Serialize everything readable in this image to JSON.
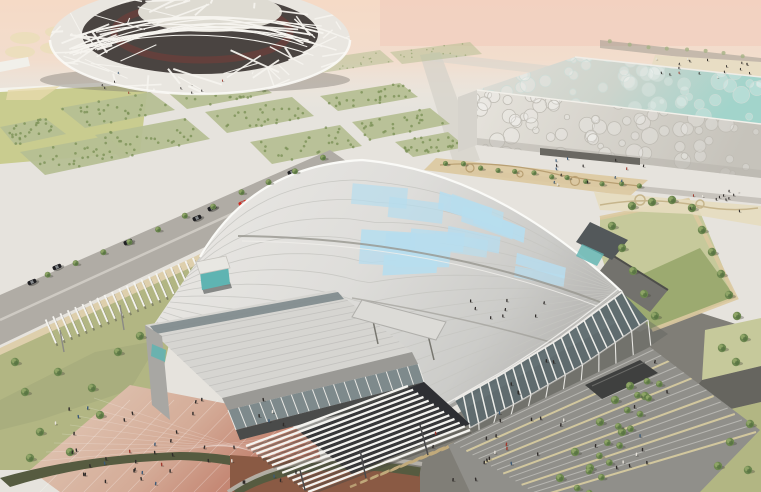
{
  "scene": {
    "description": "Aerial architectural rendering of an Olympic green: a white lattice bowl stadium at upper left, a rectangular bubble-skinned aquatics hall at upper right, and in the foreground a large arena with a curved white panel roof, blue skylight patches, glass walls, white louvered canopies, a grand stair plaza with crowds, roads with cars, lawns, tree groves and tan promenades under a hazy pink horizon.",
    "palette": {
      "skyTop": "#f5dac6",
      "skyPink": "#f1cbbb",
      "haze": "#efe9df",
      "ground": "#e6e3dd",
      "groundFar": "#edeae3",
      "pavementDark": "#807e77",
      "pavementMid": "#9c9a94",
      "roadLeft": "#b0aca5",
      "roadLine": "#d6d2ca",
      "roadDark": "#66655f",
      "lawnPale": "#c6c99b",
      "lawn": "#b2b683",
      "lawnDark": "#94a568",
      "field": "#c9cc8f",
      "grove": "#b6bf94",
      "groveDot": "#7c9158",
      "treeFill": "#6d8750",
      "treeDark": "#4f6b3c",
      "treeLight": "#9db06f",
      "treeShadow": "rgba(70,70,58,0.35)",
      "treeFar": "#a4b184",
      "tan": "#dcc9a0",
      "tanDark": "#c2ab7c",
      "plazaPink": "#e0c6b2",
      "plazaRed": "#bd7663",
      "terracotta": "#8a5a44",
      "hedge": "#565b40",
      "roofLight": "#edecE8",
      "roofMid": "#dbdad6",
      "roofDark": "#b7b6b3",
      "roofStripe": "#c6c5c1",
      "fasciaDark": "#a3a29e",
      "roofEdgeHi": "#fafaf7",
      "skylight": "#b7ddee",
      "seam": "#97968f",
      "slat": "#f4f3ef",
      "slatShadow": "rgba(70,70,66,0.45)",
      "glassTeal": "#5fb4b2",
      "glassDark": "#5d6a6e",
      "glassMid": "#7e8a8c",
      "mullion": "#e9e8e4",
      "wingRoof": "#d6d5d1",
      "wingFascia": "#9a9995",
      "entranceDark": "#2e2f33",
      "stairBase": "#908f8a",
      "stairLine": "#bab9b4",
      "stairBeige": "#d6cba0",
      "cubeFace": "#e2dfd8",
      "cubeFaceDark": "#c2bfb7",
      "cubeRoof": "#dddbd4",
      "cubeAqua": "#a2d4cb",
      "bubble": "#bfbcb4",
      "nestWhite": "#f6f4ef",
      "nestBase": "#e9e6e0",
      "nestDark": "#4a4441",
      "nestRed": "#8a3b34",
      "nestInner": "#dedbd2",
      "carBlack": "#1f1f22",
      "carRed": "#cf2b20",
      "carGlass": "#9fa4a8",
      "peopleDark": "#2f2b29",
      "peopleRed": "#a03a2e",
      "peopleBlue": "#3c5a78",
      "peopleWhite": "#e8e4dc"
    },
    "objects": {
      "cars_left_road": [
        [
          32,
          282
        ],
        [
          57,
          267
        ],
        [
          128,
          242
        ],
        [
          197,
          218
        ],
        [
          212,
          208
        ],
        [
          292,
          172
        ]
      ],
      "car_red": [
        243,
        203
      ],
      "car_right_road": [
        666,
        394
      ],
      "grove_blocks": [
        {
          "q": [
            [
              60,
              108
            ],
            [
              150,
              92
            ],
            [
              175,
              110
            ],
            [
              85,
              128
            ]
          ],
          "far": false
        },
        {
          "q": [
            [
              165,
              90
            ],
            [
              250,
              76
            ],
            [
              272,
              93
            ],
            [
              187,
              109
            ]
          ],
          "far": false
        },
        {
          "q": [
            [
              95,
              135
            ],
            [
              185,
              118
            ],
            [
              210,
              139
            ],
            [
              120,
              158
            ]
          ],
          "far": false
        },
        {
          "q": [
            [
              205,
              112
            ],
            [
              292,
              97
            ],
            [
              314,
              116
            ],
            [
              227,
              133
            ]
          ],
          "far": false
        },
        {
          "q": [
            [
              250,
              142
            ],
            [
              340,
              125
            ],
            [
              362,
              146
            ],
            [
              272,
              164
            ]
          ],
          "far": false
        },
        {
          "q": [
            [
              0,
              127
            ],
            [
              45,
              118
            ],
            [
              66,
              134
            ],
            [
              15,
              145
            ]
          ],
          "far": false
        },
        {
          "q": [
            [
              20,
              152
            ],
            [
              106,
              136
            ],
            [
              130,
              157
            ],
            [
              45,
              175
            ]
          ],
          "far": false
        },
        {
          "q": [
            [
              320,
              96
            ],
            [
              400,
              83
            ],
            [
              418,
              97
            ],
            [
              338,
              111
            ]
          ],
          "far": false
        },
        {
          "q": [
            [
              352,
              122
            ],
            [
              430,
              108
            ],
            [
              450,
              124
            ],
            [
              370,
              140
            ]
          ],
          "far": false
        },
        {
          "q": [
            [
              395,
              142
            ],
            [
              448,
              132
            ],
            [
              466,
              147
            ],
            [
              413,
              157
            ]
          ],
          "far": false
        },
        {
          "q": [
            [
              300,
              62
            ],
            [
              380,
              50
            ],
            [
              394,
              62
            ],
            [
              314,
              74
            ]
          ],
          "far": true
        },
        {
          "q": [
            [
              150,
              60
            ],
            [
              230,
              48
            ],
            [
              244,
              60
            ],
            [
              164,
              72
            ]
          ],
          "far": true
        },
        {
          "q": [
            [
              390,
              52
            ],
            [
              470,
              42
            ],
            [
              482,
              54
            ],
            [
              402,
              64
            ]
          ],
          "far": true
        }
      ],
      "people_clusters": [
        {
          "x": 55,
          "y": 395,
          "w": 245,
          "h": 92,
          "n": 46,
          "s": 1
        },
        {
          "x": 470,
          "y": 352,
          "w": 215,
          "h": 116,
          "n": 26,
          "s": 1
        },
        {
          "x": 548,
          "y": 158,
          "w": 100,
          "h": 30,
          "n": 14,
          "s": 0.8
        },
        {
          "x": 655,
          "y": 58,
          "w": 100,
          "h": 22,
          "n": 18,
          "s": 0.7
        },
        {
          "x": 690,
          "y": 188,
          "w": 58,
          "h": 24,
          "n": 12,
          "s": 0.75
        },
        {
          "x": 470,
          "y": 300,
          "w": 80,
          "h": 40,
          "n": 8,
          "s": 0.9
        },
        {
          "x": 95,
          "y": 72,
          "w": 130,
          "h": 22,
          "n": 10,
          "s": 0.65
        },
        {
          "x": 430,
          "y": 430,
          "w": 90,
          "h": 50,
          "n": 10,
          "s": 1
        }
      ],
      "trees_near": [
        [
          25,
          392
        ],
        [
          58,
          372
        ],
        [
          92,
          388
        ],
        [
          40,
          432
        ],
        [
          118,
          352
        ],
        [
          15,
          362
        ],
        [
          70,
          452
        ],
        [
          140,
          336
        ],
        [
          100,
          415
        ],
        [
          30,
          458
        ],
        [
          575,
          452
        ],
        [
          600,
          422
        ],
        [
          615,
          400
        ],
        [
          590,
          468
        ],
        [
          630,
          386
        ],
        [
          560,
          478
        ],
        [
          622,
          432
        ],
        [
          645,
          396
        ],
        [
          730,
          442
        ],
        [
          750,
          424
        ],
        [
          718,
          466
        ],
        [
          748,
          470
        ],
        [
          722,
          348
        ],
        [
          744,
          338
        ],
        [
          736,
          362
        ],
        [
          612,
          226
        ],
        [
          622,
          248
        ],
        [
          633,
          271
        ],
        [
          644,
          294
        ],
        [
          655,
          316
        ],
        [
          692,
          208
        ],
        [
          702,
          230
        ],
        [
          712,
          252
        ],
        [
          721,
          274
        ],
        [
          729,
          295
        ],
        [
          737,
          316
        ],
        [
          632,
          206
        ],
        [
          652,
          202
        ],
        [
          672,
          200
        ]
      ],
      "tree_rows": [
        {
          "from": [
            648,
            380
          ],
          "to": [
            578,
            488
          ],
          "n": 8,
          "r": 3.4
        },
        {
          "from": [
            660,
            384
          ],
          "to": [
            590,
            492
          ],
          "n": 8,
          "r": 3.4
        },
        {
          "from": [
            446,
            163
          ],
          "to": [
            638,
            187
          ],
          "n": 12,
          "r": 2.6
        },
        {
          "from": [
            48,
            276
          ],
          "to": [
            324,
            158
          ],
          "n": 11,
          "r": 3.0
        },
        {
          "from": [
            610,
            42
          ],
          "to": [
            744,
            56
          ],
          "n": 8,
          "r": 2.0
        }
      ],
      "haze_blobs": [
        [
          25,
          38
        ],
        [
          60,
          32
        ],
        [
          95,
          28
        ],
        [
          130,
          25
        ],
        [
          20,
          52
        ],
        [
          55,
          48
        ],
        [
          88,
          44
        ],
        [
          170,
          30
        ],
        [
          205,
          26
        ]
      ]
    }
  }
}
